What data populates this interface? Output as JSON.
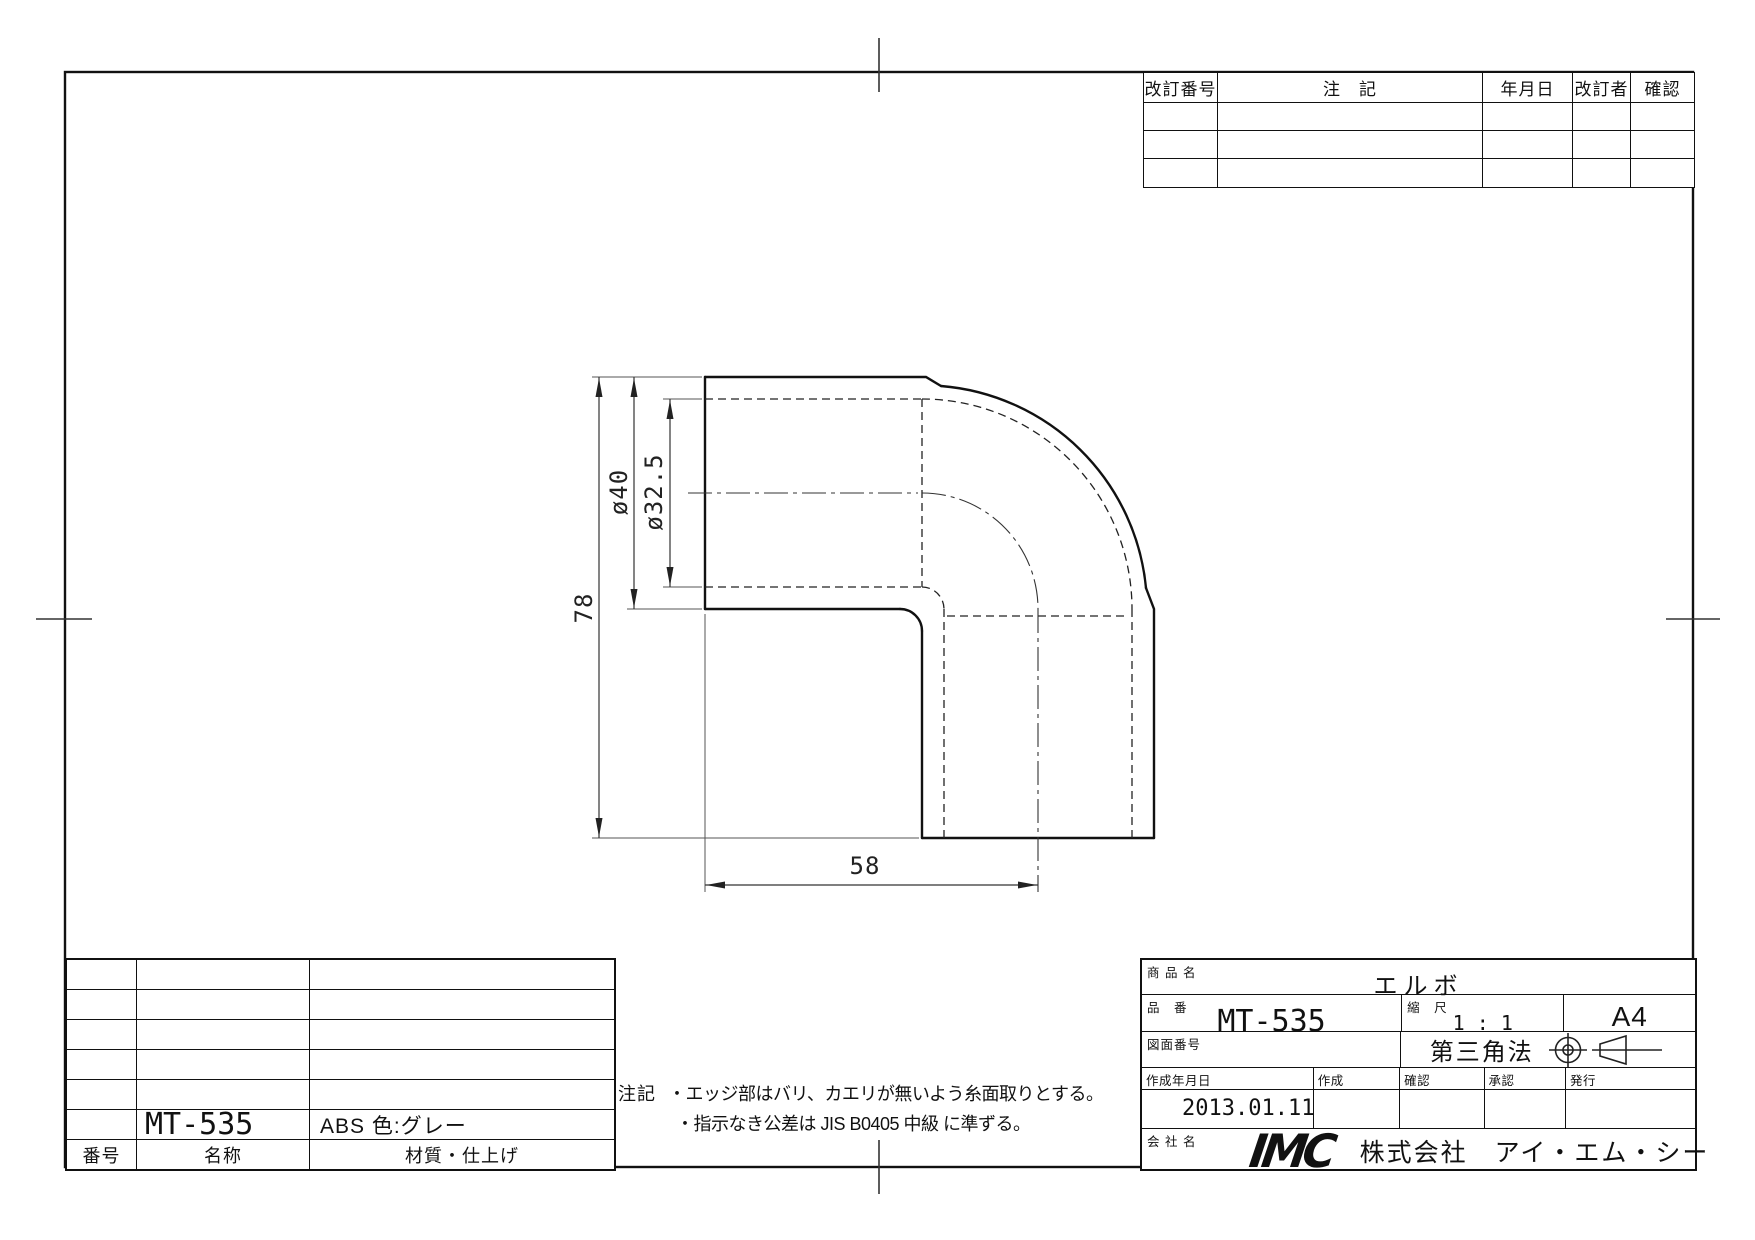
{
  "sheet": {
    "revision_table": {
      "headers": {
        "rev_no": "改訂番号",
        "note": "注　記",
        "date": "年月日",
        "revised_by": "改訂者",
        "checked": "確認"
      }
    },
    "parts_table": {
      "headers": {
        "number": "番号",
        "name": "名称",
        "material": "材質・仕上げ"
      },
      "entry": {
        "name": "MT-535",
        "material": "ABS 色:グレー"
      }
    },
    "notes": {
      "label": "注記",
      "line1": "・エッジ部はバリ、カエリが無いよう糸面取りとする。",
      "line2": "・指示なき公差は JIS B0405 中級 に準ずる。"
    },
    "title_block": {
      "product_label": "商 品 名",
      "product_name": "エルボ",
      "part_no_label": "品　番",
      "part_no": "MT-535",
      "scale_label": "縮　尺",
      "scale": "1 : 1",
      "paper_size": "A4",
      "drawing_no_label": "図面番号",
      "projection": "第三角法",
      "date_label": "作成年月日",
      "made_label": "作成",
      "check_label": "確認",
      "approve_label": "承認",
      "issue_label": "発行",
      "date": "2013.01.11",
      "company_label": "会 社 名",
      "logo": "IMC",
      "company_name": "株式会社　アイ・エム・シー"
    },
    "dimensions": {
      "height": "78",
      "outer_dia": "ø40",
      "bore_dia": "ø32.5",
      "width": "58"
    },
    "accent_colors": {
      "line": "#111111",
      "thin_line": "#555555"
    }
  }
}
